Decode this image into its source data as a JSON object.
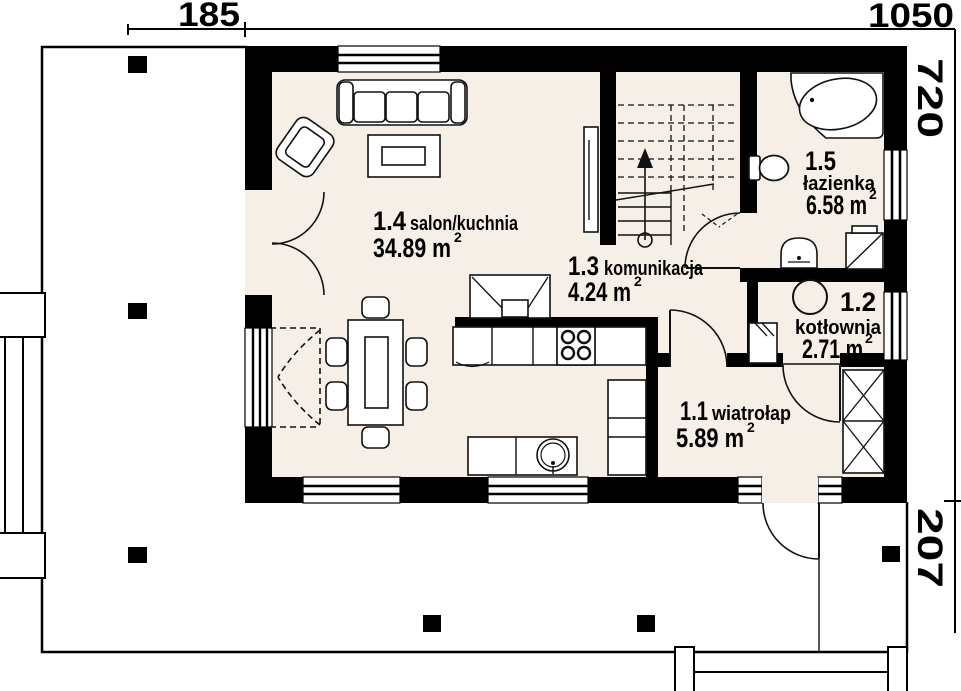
{
  "plan": {
    "type": "floor-plan",
    "language": "pl",
    "dimensions": {
      "width_left_segment": "185",
      "width_main": "1050",
      "height_main": "720",
      "height_terrace": "207"
    },
    "rooms": [
      {
        "id": "1.1",
        "name": "wiatrołap",
        "area": "5.89 m",
        "sup": "2"
      },
      {
        "id": "1.2",
        "name": "kotłownia",
        "area": "2.71 m",
        "sup": "2"
      },
      {
        "id": "1.3",
        "name": "komunikacja",
        "area": "4.24 m",
        "sup": "2"
      },
      {
        "id": "1.4",
        "name": "salon/kuchnia",
        "area": "34.89 m",
        "sup": "2"
      },
      {
        "id": "1.5",
        "name": "łazienka",
        "area": "6.58 m",
        "sup": "2"
      }
    ],
    "colors": {
      "wall": "#000000",
      "floor": "#f6efe8",
      "paper": "#ffffff",
      "line": "#111111"
    }
  }
}
